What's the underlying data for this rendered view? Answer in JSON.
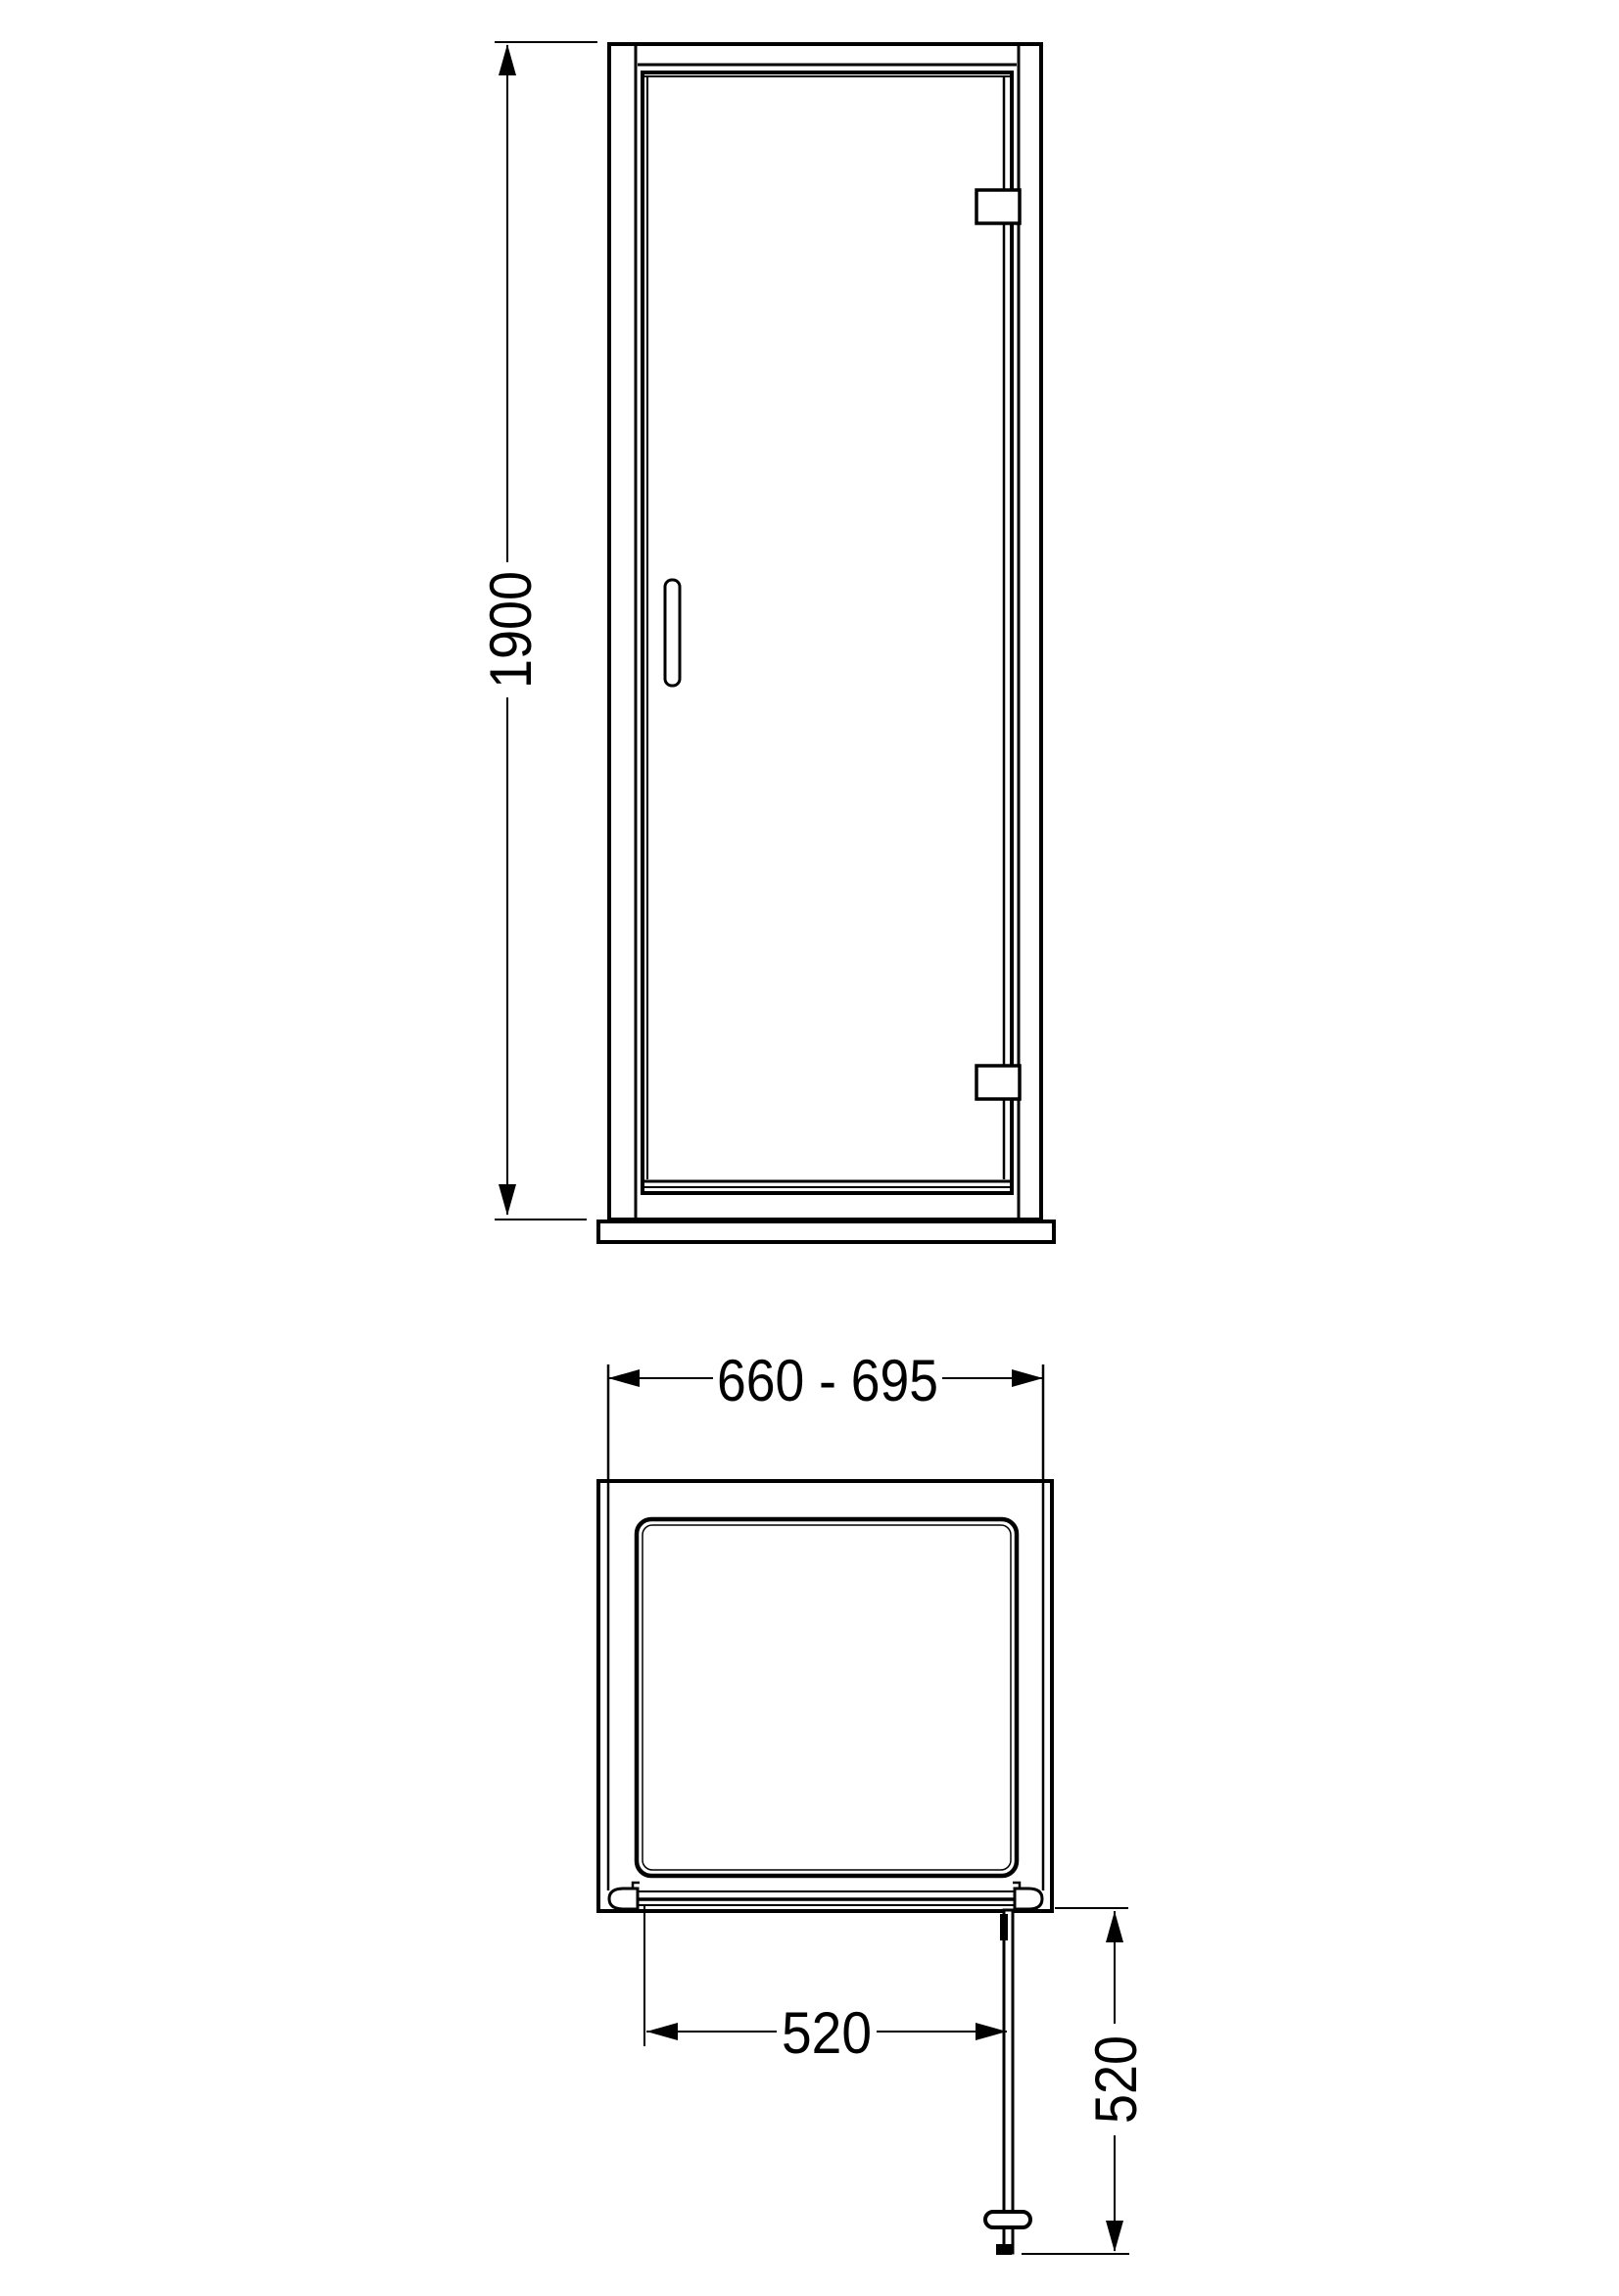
{
  "dimensions": {
    "elevation_height": "1900",
    "plan_width_range": "660 - 695",
    "door_opening_width": "520",
    "door_swing_depth": "520"
  },
  "colors": {
    "line": "#000000",
    "background": "#ffffff"
  }
}
